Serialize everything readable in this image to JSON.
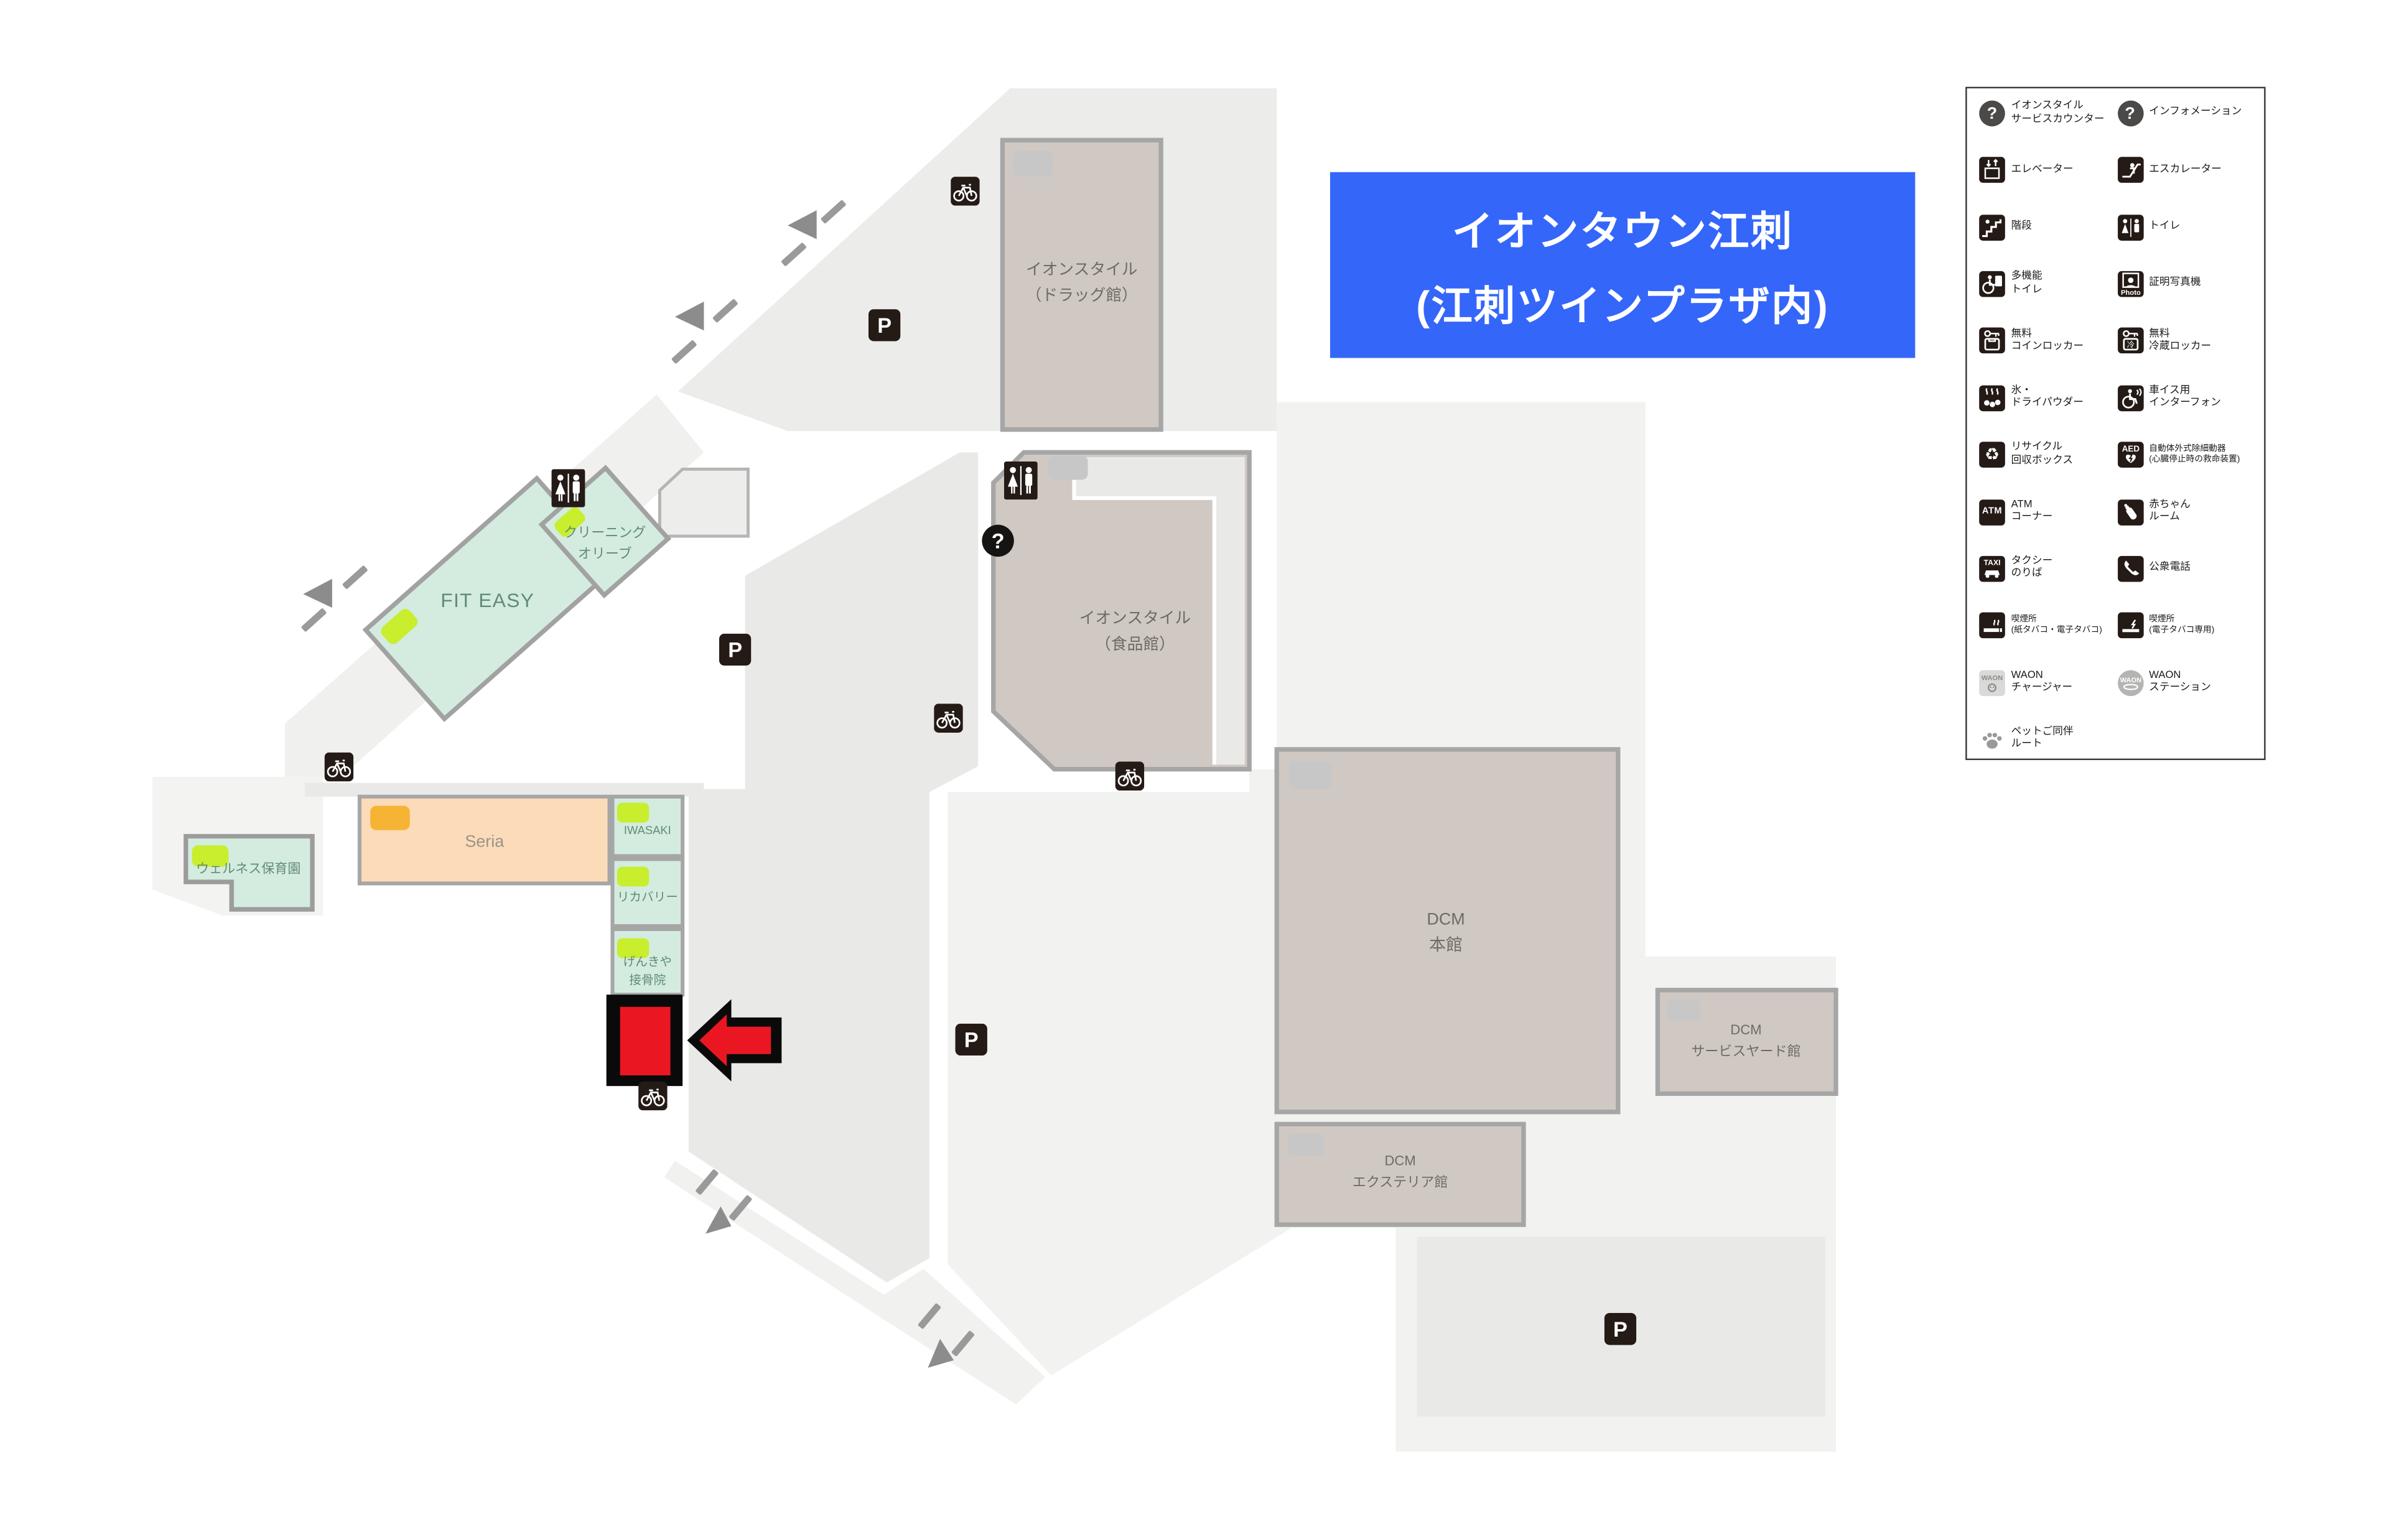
{
  "title": {
    "line1": "イオンタウン江刺",
    "line2": "(江刺ツインプラザ内)"
  },
  "colors": {
    "accent_blue": "#3566fa",
    "highlight_red": "#ea1722",
    "building_beige": "#d0c9c3",
    "building_mint": "#d3ecdf",
    "building_peach": "#fcdbb9",
    "marker_green": "#c8ee2e",
    "marker_orange": "#f6b435",
    "parking_gray": "#e9e9e8",
    "site_gray": "#f2f2f1",
    "icon_dark": "#241a16"
  },
  "map": {
    "buildings": [
      {
        "id": "aeon-drug",
        "lines": [
          "イオンスタイル",
          "（ドラッグ館）"
        ]
      },
      {
        "id": "aeon-food",
        "lines": [
          "イオンスタイル",
          "（食品館）"
        ]
      },
      {
        "id": "dcm-main",
        "lines": [
          "DCM",
          "本館"
        ]
      },
      {
        "id": "dcm-serviceyard",
        "lines": [
          "DCM",
          "サービスヤード館"
        ]
      },
      {
        "id": "dcm-exterior",
        "lines": [
          "DCM",
          "エクステリア館"
        ]
      },
      {
        "id": "seria",
        "lines": [
          "Seria"
        ]
      },
      {
        "id": "iwasaki",
        "lines": [
          "IWASAKI"
        ]
      },
      {
        "id": "recovery",
        "lines": [
          "リカバリー"
        ]
      },
      {
        "id": "genkiya",
        "lines": [
          "げんきや",
          "接骨院"
        ]
      },
      {
        "id": "fit-easy",
        "lines": [
          "FIT EASY"
        ]
      },
      {
        "id": "cleaning-olive",
        "lines": [
          "クリーニング",
          "オリーブ"
        ]
      },
      {
        "id": "wellness-nursery",
        "lines": [
          "ウェルネス保育園"
        ]
      }
    ],
    "highlight": {
      "description": "current location red box with arrow"
    }
  },
  "legend": {
    "items": [
      {
        "icon": "question",
        "lines": [
          "イオンスタイル",
          "サービスカウンター"
        ]
      },
      {
        "icon": "question",
        "lines": [
          "インフォメーション"
        ]
      },
      {
        "icon": "elevator",
        "lines": [
          "エレベーター"
        ]
      },
      {
        "icon": "escalator",
        "lines": [
          "エスカレーター"
        ]
      },
      {
        "icon": "stairs",
        "lines": [
          "階段"
        ]
      },
      {
        "icon": "toilet",
        "lines": [
          "トイレ"
        ]
      },
      {
        "icon": "multifunction-toilet",
        "lines": [
          "多機能",
          "トイレ"
        ]
      },
      {
        "icon": "photo-booth",
        "lines": [
          "証明写真機"
        ]
      },
      {
        "icon": "coin-locker",
        "lines": [
          "無料",
          "コインロッカー"
        ]
      },
      {
        "icon": "cold-locker",
        "lines": [
          "無料",
          "冷蔵ロッカー"
        ]
      },
      {
        "icon": "ice",
        "lines": [
          "氷・",
          "ドライパウダー"
        ]
      },
      {
        "icon": "wheelchair-intercom",
        "lines": [
          "車イス用",
          "インターフォン"
        ]
      },
      {
        "icon": "recycle",
        "lines": [
          "リサイクル",
          "回収ボックス"
        ]
      },
      {
        "icon": "aed",
        "lines": [
          "自動体外式除細動器",
          "(心臓停止時の救命装置)"
        ]
      },
      {
        "icon": "atm",
        "lines": [
          "ATM",
          "コーナー"
        ]
      },
      {
        "icon": "baby-room",
        "lines": [
          "赤ちゃん",
          "ルーム"
        ]
      },
      {
        "icon": "taxi",
        "lines": [
          "タクシー",
          "のりば"
        ]
      },
      {
        "icon": "public-phone",
        "lines": [
          "公衆電話"
        ]
      },
      {
        "icon": "smoking",
        "lines": [
          "喫煙所",
          "(紙タバコ・電子タバコ)"
        ]
      },
      {
        "icon": "e-smoking",
        "lines": [
          "喫煙所",
          "(電子タバコ専用)"
        ]
      },
      {
        "icon": "waon-charger",
        "lines": [
          "WAON",
          "チャージャー"
        ]
      },
      {
        "icon": "waon-station",
        "lines": [
          "WAON",
          "ステーション"
        ]
      },
      {
        "icon": "pet-route",
        "lines": [
          "ペットご同伴",
          "ルート"
        ]
      }
    ]
  }
}
